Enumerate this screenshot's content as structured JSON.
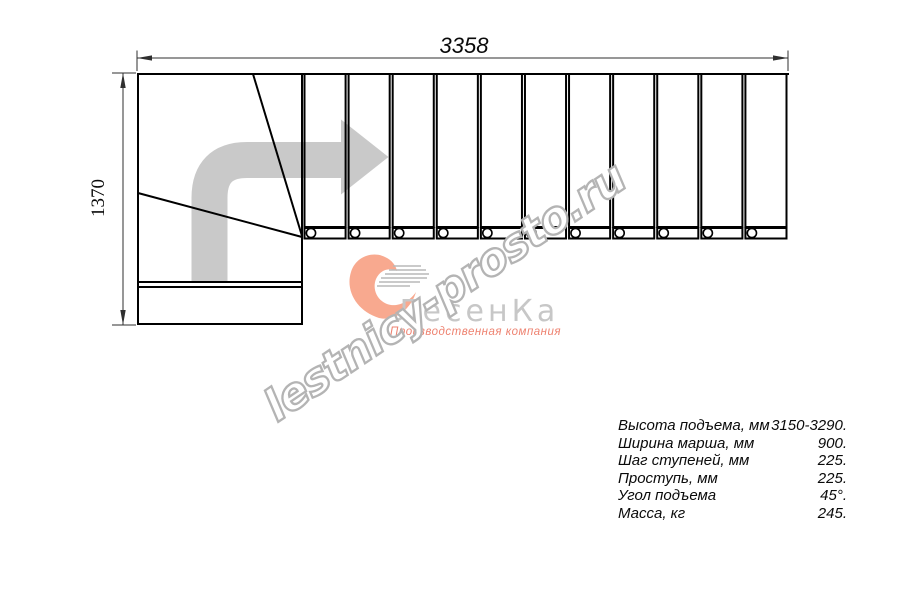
{
  "drawing": {
    "width_label": "3358",
    "height_label": "1370",
    "straight_flight_steps": 11,
    "line_color": "#000000",
    "dim_color": "#2f2f2f",
    "arrow_color": "#c9c9c9"
  },
  "watermark": {
    "text": "lestnicy-prosto.ru",
    "color": "#b4b4b4"
  },
  "logo": {
    "brand": "ЛесенКа",
    "subtitle": "Производственная компания",
    "brand_color": "#c7c7c7",
    "accent_color": "#ee8270",
    "swoosh_color": "#f8a98f",
    "swoosh_lines_color": "#b9b9b9"
  },
  "specs": {
    "rows": [
      {
        "label": "Высота подъема, мм",
        "value": "3150-3290."
      },
      {
        "label": "Ширина марша, мм",
        "value": "900."
      },
      {
        "label": "Шаг ступеней, мм",
        "value": "225."
      },
      {
        "label": "Проступь, мм",
        "value": "225."
      },
      {
        "label": "Угол подъема",
        "value": "45°."
      },
      {
        "label": "Масса, кг",
        "value": "245."
      }
    ]
  }
}
